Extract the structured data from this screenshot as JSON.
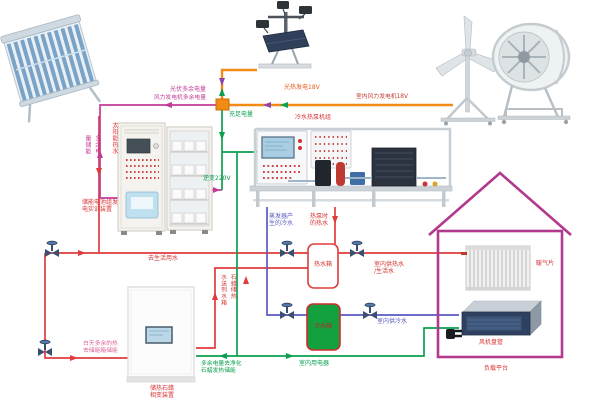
{
  "labels": {
    "solar_hot_water": "太阳能热水",
    "pv_excess": "光伏多余电量",
    "wind_excess": "风力发电机多余电量",
    "excess_storage": "多余电\n量储能",
    "pv_gen": "光热发电18V",
    "wind_gen": "室内风力发电机18V",
    "sufficient": "充足电量",
    "heat_pump": "冷水热泵机组",
    "inverter": "逆变220V",
    "battery_device": "储能电池组发\n电实训装置",
    "to_domestic": "去生活用水",
    "evap_cold": "蒸发器产\n生的冷水",
    "hp_hot": "热泵时\n的热水",
    "hot_tank": "热水箱",
    "cold_tank": "冷水箱",
    "indoor_hot": "室内供热水\n/生活水",
    "indoor_cold": "室内供冷水",
    "radiator": "暖气片",
    "fan_coil": "风机盘管",
    "load_platform": "负载平台",
    "paraffin_to_tank": "石蜡储热\n水送到水箱",
    "day_excess": "白天多余的热\n去储能箱储能",
    "paraffin_device": "储热石蜡\n相变装置",
    "excess_to_paraffin": "多余电量去净化\n石蜡发热储能",
    "indoor_appliance": "室内用电器"
  },
  "colors": {
    "hot_water_line": "#e03c3c",
    "cold_water_line": "#5a5ac2",
    "excess_power_line": "#c43b97",
    "generation_line": "#f28b16",
    "supply_power_line": "#0aa04f",
    "house_outline": "#b13a8e",
    "cold_tank_fill": "#12a13e",
    "junction_box_fill": "#f28b16"
  }
}
